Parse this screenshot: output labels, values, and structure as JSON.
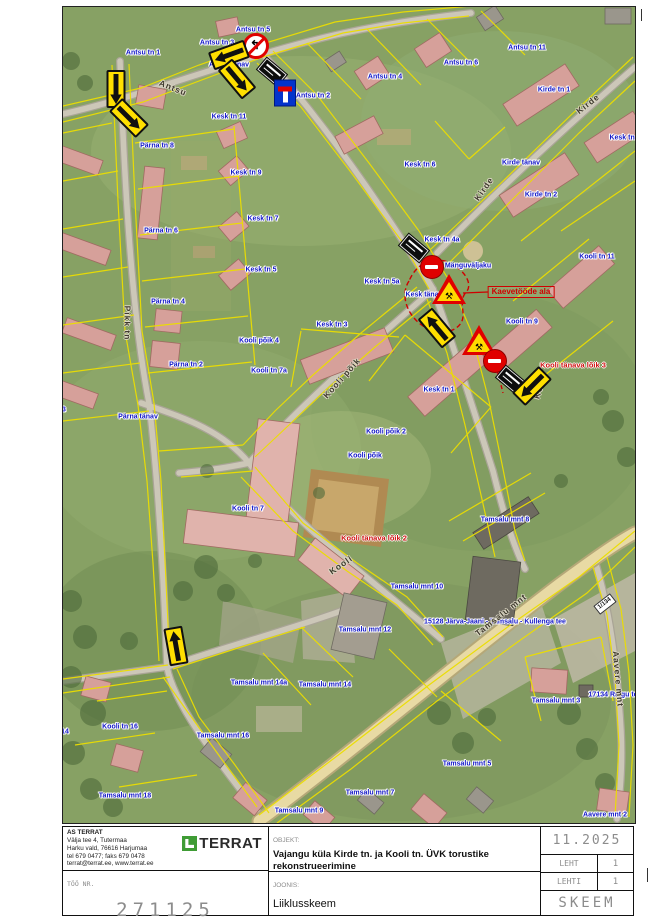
{
  "titleblock": {
    "company": {
      "lines": [
        "AS TERRAT",
        "Välja tee 4, Tutermaa",
        "Harku vald, 76616 Harjumaa",
        "tel 679 0477; faks 679 0478",
        "terrat@terrat.ee, www.terrat.ee"
      ]
    },
    "logo": "TERRAT",
    "objekt_label": "OBJEKT:",
    "objekt": "Vajangu küla Kirde tn. ja Kooli tn. ÜVK torustike rekonstrueerimine",
    "too_label": "TÖÖ NR.",
    "too": "271125",
    "joonis_label": "JOONIS:",
    "joonis": "Liiklusskeem",
    "date": "11.2025",
    "leht_label": "LEHT",
    "leht": "1",
    "lehti_label": "LEHTI",
    "lehti": "1",
    "skeem": "SKEEM"
  },
  "map": {
    "colors": {
      "parcel_line": "#ecde00",
      "work_zone": "#d00000",
      "address_text": "#1216c8"
    },
    "labels": [
      {
        "t": "Antsu tn 5",
        "x": 252,
        "y": 29,
        "c": "addr"
      },
      {
        "t": "Antsu tn 3",
        "x": 216,
        "y": 42,
        "c": "addr"
      },
      {
        "t": "Antsu tn 1",
        "x": 142,
        "y": 52,
        "c": "addr"
      },
      {
        "t": "Antsu tänav",
        "x": 228,
        "y": 64,
        "c": "addr"
      },
      {
        "t": "Antsu tn 2",
        "x": 312,
        "y": 95,
        "c": "addr"
      },
      {
        "t": "Antsu tn 4",
        "x": 384,
        "y": 76,
        "c": "addr"
      },
      {
        "t": "Antsu tn 6",
        "x": 460,
        "y": 62,
        "c": "addr"
      },
      {
        "t": "Antsu tn 11",
        "x": 526,
        "y": 47,
        "c": "addr"
      },
      {
        "t": "Kirde tn 1",
        "x": 553,
        "y": 89,
        "c": "addr"
      },
      {
        "t": "Kesk tn 2",
        "x": 624,
        "y": 137,
        "c": "addr"
      },
      {
        "t": "Kirde tänav",
        "x": 520,
        "y": 162,
        "c": "addr"
      },
      {
        "t": "Kirde tn 2",
        "x": 540,
        "y": 194,
        "c": "addr"
      },
      {
        "t": "Kesk tn 6",
        "x": 419,
        "y": 164,
        "c": "addr"
      },
      {
        "t": "Kesk tn 11",
        "x": 228,
        "y": 116,
        "c": "addr"
      },
      {
        "t": "Kesk tn 9",
        "x": 245,
        "y": 172,
        "c": "addr"
      },
      {
        "t": "Kesk tn 7",
        "x": 262,
        "y": 218,
        "c": "addr"
      },
      {
        "t": "Kesk tn 5",
        "x": 260,
        "y": 269,
        "c": "addr"
      },
      {
        "t": "Pärna tn 8",
        "x": 156,
        "y": 145,
        "c": "addr"
      },
      {
        "t": "Pärna tn 6",
        "x": 160,
        "y": 230,
        "c": "addr"
      },
      {
        "t": "Pärna tn 4",
        "x": 167,
        "y": 301,
        "c": "addr"
      },
      {
        "t": "Pärna tn 2",
        "x": 185,
        "y": 364,
        "c": "addr"
      },
      {
        "t": "Pärna tn 3",
        "x": 48,
        "y": 409,
        "c": "addr"
      },
      {
        "t": "Pärna tänav",
        "x": 137,
        "y": 416,
        "c": "addr"
      },
      {
        "t": "Kooli põik 4",
        "x": 258,
        "y": 340,
        "c": "addr"
      },
      {
        "t": "Kooli tn 7a",
        "x": 268,
        "y": 370,
        "c": "addr"
      },
      {
        "t": "Kesk tn 5a",
        "x": 381,
        "y": 281,
        "c": "addr"
      },
      {
        "t": "Kesk tn 4a",
        "x": 441,
        "y": 239,
        "c": "addr"
      },
      {
        "t": "Kesk tänav",
        "x": 423,
        "y": 294,
        "c": "addr"
      },
      {
        "t": "Kesk tn 3",
        "x": 331,
        "y": 324,
        "c": "addr"
      },
      {
        "t": "Mänguväljaku",
        "x": 467,
        "y": 265,
        "c": "addr"
      },
      {
        "t": "Kooli tn 11",
        "x": 596,
        "y": 256,
        "c": "addr"
      },
      {
        "t": "Kooli tn 9",
        "x": 521,
        "y": 321,
        "c": "addr"
      },
      {
        "t": "Kesk tn 1",
        "x": 438,
        "y": 389,
        "c": "addr"
      },
      {
        "t": "Kooli põik 2",
        "x": 385,
        "y": 431,
        "c": "addr"
      },
      {
        "t": "Kooli põik",
        "x": 364,
        "y": 455,
        "c": "addr"
      },
      {
        "t": "Kooli tn 7",
        "x": 247,
        "y": 508,
        "c": "addr"
      },
      {
        "t": "Kooli tn 16",
        "x": 119,
        "y": 726,
        "c": "addr"
      },
      {
        "t": "Kooli tn 14",
        "x": 50,
        "y": 731,
        "c": "addr"
      },
      {
        "t": "Tamsalu mnt 14a",
        "x": 258,
        "y": 682,
        "c": "addr"
      },
      {
        "t": "Tamsalu mnt 16",
        "x": 222,
        "y": 735,
        "c": "addr"
      },
      {
        "t": "Tamsalu mnt 18",
        "x": 124,
        "y": 795,
        "c": "addr"
      },
      {
        "t": "Tamsalu mnt 14",
        "x": 324,
        "y": 684,
        "c": "addr"
      },
      {
        "t": "Tamsalu mnt 12",
        "x": 364,
        "y": 629,
        "c": "addr"
      },
      {
        "t": "Tamsalu mnt 10",
        "x": 416,
        "y": 586,
        "c": "addr"
      },
      {
        "t": "Tamsalu mnt 9",
        "x": 298,
        "y": 810,
        "c": "addr"
      },
      {
        "t": "Tamsalu mnt 7",
        "x": 369,
        "y": 792,
        "c": "addr"
      },
      {
        "t": "Tamsalu mnt 8",
        "x": 504,
        "y": 519,
        "c": "addr"
      },
      {
        "t": "Tamsalu mnt 5",
        "x": 466,
        "y": 763,
        "c": "addr"
      },
      {
        "t": "Tamsalu mnt 3",
        "x": 555,
        "y": 700,
        "c": "addr"
      },
      {
        "t": "Aavere mnt 2",
        "x": 604,
        "y": 814,
        "c": "addr"
      },
      {
        "t": "15128 Järva-Jaani - Tamsalu - Kullenga tee",
        "x": 494,
        "y": 621,
        "c": "addr"
      },
      {
        "t": "17134 Raigu tee",
        "x": 614,
        "y": 694,
        "c": "addr"
      },
      {
        "t": "Kaevetööde ala",
        "x": 520,
        "y": 291,
        "c": "redbox"
      },
      {
        "t": "Kooli tänava lõik 3",
        "x": 572,
        "y": 364,
        "c": "red"
      },
      {
        "t": "Kooli tänava lõik 2",
        "x": 373,
        "y": 537,
        "c": "red"
      },
      {
        "t": "Antsu",
        "x": 172,
        "y": 87,
        "c": "street",
        "r": 22
      },
      {
        "t": "Kirde",
        "x": 483,
        "y": 188,
        "c": "street",
        "r": -55
      },
      {
        "t": "Kirde",
        "x": 587,
        "y": 103,
        "c": "street",
        "r": -38
      },
      {
        "t": "Pikk tn",
        "x": 126,
        "y": 322,
        "c": "street",
        "r": 90
      },
      {
        "t": "Kooli põik",
        "x": 341,
        "y": 377,
        "c": "street",
        "r": -48
      },
      {
        "t": "Kooli",
        "x": 340,
        "y": 564,
        "c": "street",
        "r": -35
      },
      {
        "t": "Kooli",
        "x": 539,
        "y": 385,
        "c": "street",
        "r": -75
      },
      {
        "t": "Tamsalu mnt",
        "x": 500,
        "y": 614,
        "c": "street",
        "r": -38
      },
      {
        "t": "Aavere mnt",
        "x": 617,
        "y": 678,
        "c": "street",
        "r": 85
      }
    ],
    "signs": [
      {
        "type": "noleft",
        "x": 255,
        "y": 45,
        "r": 0
      },
      {
        "type": "plate",
        "x": 271,
        "y": 71,
        "r": 40
      },
      {
        "type": "deadend",
        "x": 284,
        "y": 92,
        "r": 0
      },
      {
        "type": "arrow",
        "x": 115,
        "y": 88,
        "r": 180
      },
      {
        "type": "arrow",
        "x": 128,
        "y": 117,
        "r": 135
      },
      {
        "type": "arrow",
        "x": 228,
        "y": 54,
        "r": 250
      },
      {
        "type": "arrow",
        "x": 236,
        "y": 78,
        "r": 140
      },
      {
        "type": "plate",
        "x": 413,
        "y": 247,
        "r": 40
      },
      {
        "type": "noentry",
        "x": 431,
        "y": 266,
        "r": 0
      },
      {
        "type": "roadworks",
        "x": 448,
        "y": 288,
        "r": 0
      },
      {
        "type": "arrow",
        "x": 436,
        "y": 327,
        "r": -40
      },
      {
        "type": "roadworks",
        "x": 478,
        "y": 339,
        "r": 0
      },
      {
        "type": "noentry",
        "x": 494,
        "y": 360,
        "r": 0
      },
      {
        "type": "plate",
        "x": 510,
        "y": 379,
        "r": 40
      },
      {
        "type": "arrow",
        "x": 531,
        "y": 385,
        "r": 225
      },
      {
        "type": "arrow",
        "x": 175,
        "y": 645,
        "r": -10
      },
      {
        "type": "kmplate",
        "x": 604,
        "y": 603,
        "r": -38,
        "t": "1/134"
      }
    ]
  }
}
